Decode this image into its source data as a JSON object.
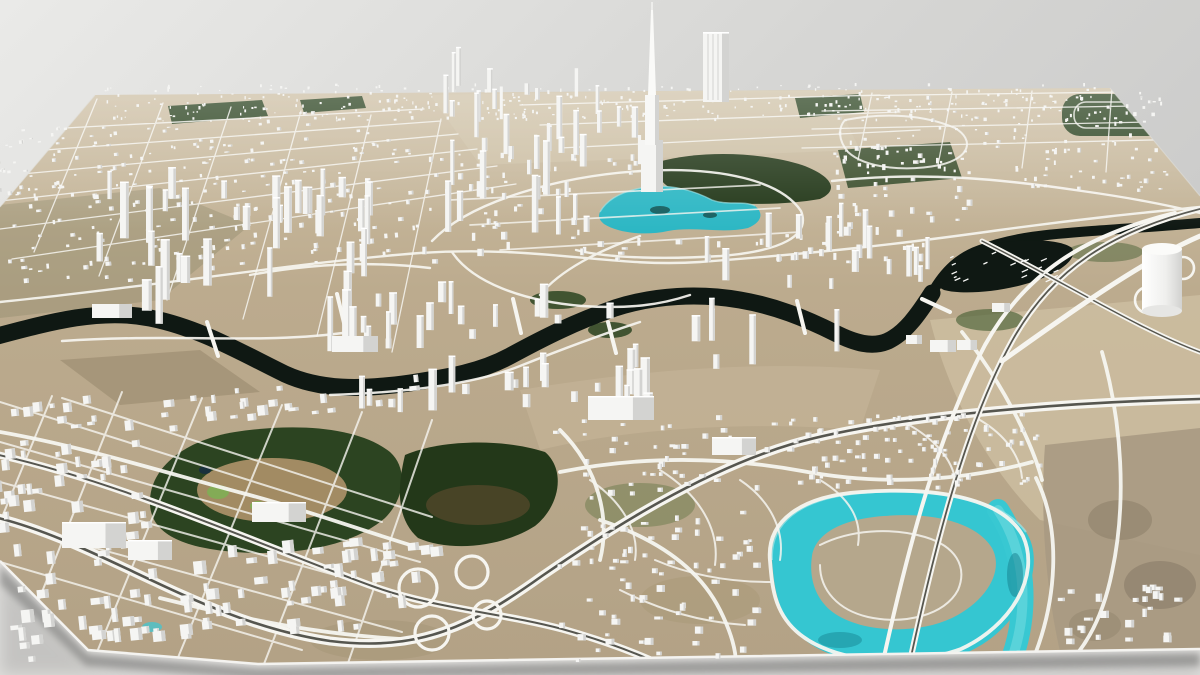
{
  "palette": {
    "background_top_left": "#e9e9e7",
    "background_right": "#cecece",
    "floor": "#e1e0de",
    "ground_far": "#cbbda1",
    "ground_mid": "#b9a98c",
    "ground_near": "#b3a286",
    "park": "#2c4421",
    "park_dark": "#233819",
    "park_light": "#7fae54",
    "canal_water": "#0f1813",
    "lagoon_water": "#35c6d1",
    "lagoon_highlight": "#9fe5e8",
    "road": "#f6f5f0",
    "motorway_median": "#56564f",
    "building_face": "#f5f5f3",
    "building_side": "#d3d3d1",
    "building_top": "#ffffff",
    "rim": "#f4f3f0",
    "shadow": "#70706e"
  },
  "scene": {
    "type": "3d-city-model-on-satellite-basemap",
    "view": "oblique-aerial",
    "horizon_y": 88,
    "avoid": [
      [
        593,
        178,
        175,
        62
      ],
      [
        655,
        148,
        180,
        52
      ],
      [
        758,
        490,
        295,
        185
      ],
      [
        148,
        428,
        260,
        130
      ],
      [
        398,
        438,
        175,
        118
      ],
      [
        930,
        240,
        150,
        55
      ],
      [
        1130,
        240,
        70,
        80
      ],
      [
        0,
        318,
        150,
        40
      ],
      [
        150,
        330,
        160,
        55
      ],
      [
        310,
        355,
        120,
        45
      ],
      [
        430,
        345,
        90,
        40
      ],
      [
        520,
        325,
        90,
        40
      ],
      [
        610,
        295,
        140,
        35
      ],
      [
        750,
        295,
        110,
        45
      ],
      [
        855,
        325,
        60,
        40
      ],
      [
        880,
        285,
        70,
        55
      ],
      [
        940,
        230,
        130,
        40
      ]
    ],
    "clusters": [
      {
        "name": "horizon-band",
        "seed": 11,
        "area": [
          105,
          86,
          1000,
          36
        ],
        "count": 300,
        "size": [
          2,
          5
        ],
        "height": [
          2,
          7
        ]
      },
      {
        "name": "oldtown-northwest",
        "seed": 12,
        "area": [
          0,
          115,
          420,
          160
        ],
        "count": 260,
        "size": [
          3,
          8
        ],
        "height": [
          2,
          7
        ],
        "rot": -5
      },
      {
        "name": "midtown-blocks",
        "seed": 13,
        "area": [
          420,
          150,
          560,
          115
        ],
        "count": 180,
        "size": [
          3,
          9
        ],
        "height": [
          3,
          11
        ]
      },
      {
        "name": "downtown-towers",
        "seed": 14,
        "area": [
          435,
          85,
          255,
          155
        ],
        "count": 55,
        "size": [
          5,
          11
        ],
        "height": [
          22,
          85
        ]
      },
      {
        "name": "bay-west-towers",
        "seed": 15,
        "area": [
          80,
          195,
          300,
          175
        ],
        "count": 50,
        "size": [
          6,
          12
        ],
        "height": [
          18,
          78
        ]
      },
      {
        "name": "canal-south-midrise",
        "seed": 16,
        "area": [
          330,
          300,
          330,
          115
        ],
        "count": 55,
        "size": [
          5,
          10
        ],
        "height": [
          8,
          40
        ]
      },
      {
        "name": "east-towers",
        "seed": 17,
        "area": [
          690,
          230,
          250,
          145
        ],
        "count": 38,
        "size": [
          5,
          10
        ],
        "height": [
          10,
          55
        ]
      },
      {
        "name": "northeast-city",
        "seed": 18,
        "area": [
          830,
          92,
          340,
          100
        ],
        "count": 150,
        "size": [
          3,
          7
        ],
        "height": [
          2,
          8
        ]
      },
      {
        "name": "southwest-grid",
        "seed": 19,
        "area": [
          0,
          390,
          440,
          255
        ],
        "count": 260,
        "size": [
          4,
          11
        ],
        "height": [
          3,
          10
        ],
        "rot": -6
      },
      {
        "name": "suburb-west",
        "seed": 20,
        "area": [
          555,
          420,
          250,
          245
        ],
        "count": 150,
        "size": [
          3,
          7
        ],
        "height": [
          2,
          5
        ]
      },
      {
        "name": "suburb-north",
        "seed": 21,
        "area": [
          790,
          415,
          255,
          85
        ],
        "count": 110,
        "size": [
          3,
          6
        ],
        "height": [
          2,
          5
        ]
      },
      {
        "name": "lagoon-island-villas",
        "seed": 22,
        "area": [
          818,
          518,
          168,
          105
        ],
        "count": 90,
        "size": [
          3,
          6
        ],
        "height": [
          2,
          4
        ]
      },
      {
        "name": "desert-camp",
        "seed": 23,
        "area": [
          1060,
          590,
          120,
          55
        ],
        "count": 25,
        "size": [
          3,
          7
        ],
        "height": [
          2,
          6
        ]
      },
      {
        "name": "large-slab-buildings",
        "explicit": [
          [
            62,
            548,
            64,
            26
          ],
          [
            252,
            522,
            54,
            20
          ],
          [
            588,
            420,
            66,
            24
          ],
          [
            92,
            318,
            40,
            14
          ],
          [
            332,
            352,
            46,
            16
          ],
          [
            930,
            352,
            26,
            12
          ],
          [
            957,
            350,
            20,
            10
          ],
          [
            906,
            344,
            16,
            9
          ],
          [
            992,
            312,
            18,
            9
          ],
          [
            712,
            455,
            44,
            18
          ],
          [
            128,
            560,
            44,
            20
          ]
        ]
      }
    ],
    "boats": {
      "seed": 31,
      "area": [
        946,
        252,
        112,
        30
      ],
      "count": 20,
      "length": [
        3,
        7
      ]
    }
  }
}
